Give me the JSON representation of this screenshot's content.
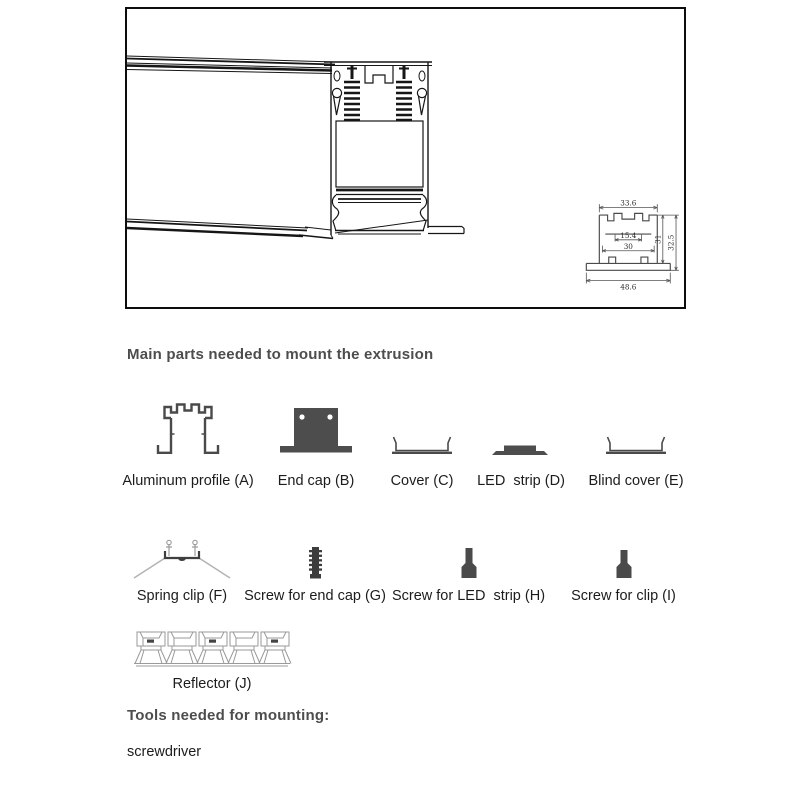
{
  "figure": {
    "dimensions": {
      "top_width": "33.6",
      "slot_width": "15.4",
      "channel_width": "30",
      "inner_height": "31",
      "overall_height": "32.5",
      "base_width": "48.6"
    }
  },
  "parts_section": {
    "heading": "Main parts needed to mount the extrusion",
    "row1": [
      {
        "label": "Aluminum profile (A)"
      },
      {
        "label": "End cap (B)"
      },
      {
        "label": "Cover (C)"
      },
      {
        "label": "LED  strip (D)"
      },
      {
        "label": "Blind cover (E)"
      }
    ],
    "row2": [
      {
        "label": "Spring clip (F)"
      },
      {
        "label": "Screw for end cap (G)"
      },
      {
        "label": "Screw for LED  strip (H)"
      },
      {
        "label": "Screw for clip (I)"
      }
    ],
    "row3": [
      {
        "label": "Reflector (J)"
      }
    ]
  },
  "tools_section": {
    "heading": "Tools needed for mounting:",
    "items": [
      "screwdriver"
    ]
  },
  "colors": {
    "heading": "#4d4d4d",
    "label": "#1c1c1c",
    "line": "#161616",
    "icon_dark": "#4d4d4d",
    "light_line": "#9a9a9a"
  }
}
